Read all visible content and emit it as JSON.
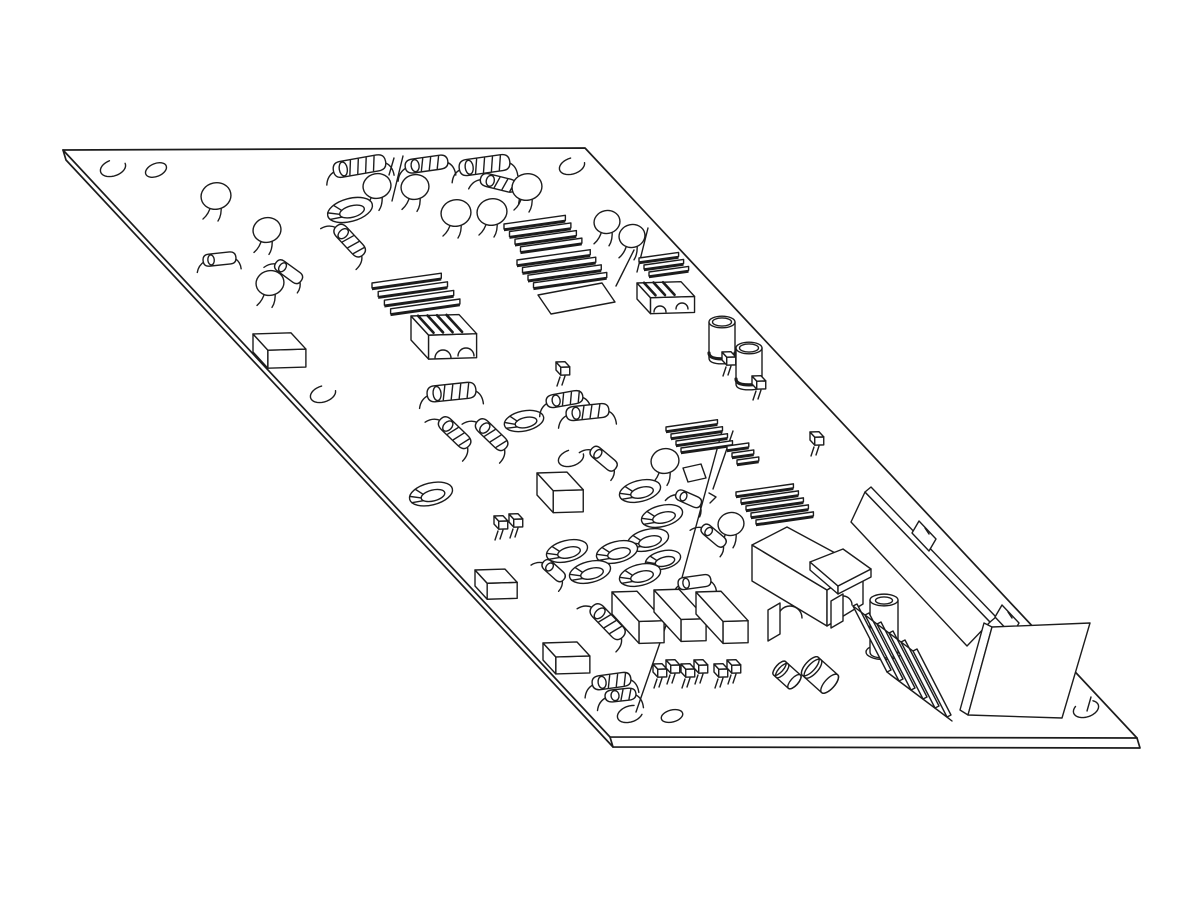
{
  "meta": {
    "title": "isometric-pcb-line-drawing",
    "background_color": "#ffffff",
    "line_color": "#1c1c1c",
    "canvas": {
      "width": 1200,
      "height": 900
    }
  },
  "board": {
    "outline": [
      [
        63,
        150
      ],
      [
        585,
        148
      ],
      [
        1137,
        738
      ],
      [
        610,
        737
      ]
    ],
    "thickness": [
      [
        63,
        150
      ],
      [
        66,
        160
      ],
      [
        613,
        747
      ],
      [
        1140,
        748
      ],
      [
        1137,
        738
      ]
    ],
    "corner_edge": [
      610,
      737,
      613,
      747
    ]
  },
  "holes": [
    {
      "k": "c",
      "x": 113,
      "y": 168,
      "g": -50
    },
    {
      "k": "e",
      "x": 156,
      "y": 170,
      "rx": 11,
      "ry": 6.5,
      "rot": -22
    },
    {
      "k": "c",
      "x": 572,
      "y": 166,
      "g": -40
    },
    {
      "k": "c",
      "x": 323,
      "y": 394,
      "g": -40
    },
    {
      "k": "c",
      "x": 571,
      "y": 458,
      "g": -45
    },
    {
      "k": "c",
      "x": 630,
      "y": 714,
      "g": -15
    },
    {
      "k": "e",
      "x": 672,
      "y": 716,
      "rx": 11,
      "ry": 6,
      "rot": -15
    },
    {
      "k": "c",
      "x": 1086,
      "y": 709,
      "g": -90
    }
  ],
  "marks": [
    {
      "l": [
        403,
        156,
        392,
        201
      ]
    },
    {
      "l": [
        394,
        158,
        389,
        175
      ]
    },
    {
      "l": [
        648,
        228,
        637,
        272
      ]
    },
    {
      "l": [
        634,
        250,
        616,
        286
      ]
    },
    {
      "pl": [
        [
          722,
          431
        ],
        [
          680,
          585
        ],
        [
          636,
          712
        ]
      ]
    },
    {
      "l": [
        733,
        431,
        713,
        489
      ]
    },
    {
      "pl": [
        [
          709,
          493
        ],
        [
          716,
          497
        ],
        [
          710,
          503
        ]
      ]
    },
    {
      "l": [
        1091,
        697,
        1087,
        711
      ]
    }
  ],
  "components": [
    {
      "t": "disc",
      "x": 216,
      "y": 196,
      "r": 15
    },
    {
      "t": "disc",
      "x": 267,
      "y": 230,
      "r": 14
    },
    {
      "t": "diode",
      "x": 220,
      "y": 259,
      "a": -6,
      "l": 28,
      "r": 6
    },
    {
      "t": "disc",
      "x": 270,
      "y": 283,
      "r": 14
    },
    {
      "t": "diode",
      "x": 289,
      "y": 272,
      "a": 36,
      "l": 26,
      "r": 6
    },
    {
      "t": "res",
      "x": 360,
      "y": 166,
      "a": -10,
      "l": 46,
      "r": 8,
      "b": 4
    },
    {
      "t": "disc",
      "x": 377,
      "y": 186,
      "r": 14
    },
    {
      "t": "disc",
      "x": 415,
      "y": 187,
      "r": 14
    },
    {
      "t": "toroid",
      "x": 350,
      "y": 210,
      "rot": -15,
      "rx": 23
    },
    {
      "t": "res",
      "x": 350,
      "y": 241,
      "a": 47,
      "l": 32,
      "r": 7,
      "b": 3
    },
    {
      "t": "res",
      "x": 427,
      "y": 164,
      "a": -8,
      "l": 36,
      "r": 7,
      "b": 3
    },
    {
      "t": "res",
      "x": 485,
      "y": 165,
      "a": -8,
      "l": 44,
      "r": 8,
      "b": 4
    },
    {
      "t": "res",
      "x": 499,
      "y": 183,
      "a": 14,
      "l": 30,
      "r": 6.5,
      "b": 3
    },
    {
      "t": "disc",
      "x": 527,
      "y": 187,
      "r": 15
    },
    {
      "t": "disc",
      "x": 456,
      "y": 213,
      "r": 15
    },
    {
      "t": "disc",
      "x": 492,
      "y": 212,
      "r": 15
    },
    {
      "t": "disc",
      "x": 607,
      "y": 222,
      "r": 13
    },
    {
      "t": "disc",
      "x": 632,
      "y": 236,
      "r": 13
    },
    {
      "t": "hs",
      "fins": [
        {
          "x": 504,
          "y": 224,
          "n": 4,
          "len": 62,
          "sx": 5.5,
          "sy": 7.6,
          "fh": 5
        },
        {
          "x": 517,
          "y": 260,
          "n": 4,
          "len": 74,
          "sx": 5.5,
          "sy": 7.6,
          "fh": 5
        }
      ],
      "plate": [
        [
          538,
          295
        ],
        [
          602,
          283
        ],
        [
          615,
          302
        ],
        [
          551,
          314
        ]
      ]
    },
    {
      "t": "hs",
      "fins": [
        {
          "x": 639,
          "y": 258,
          "n": 3,
          "len": 40,
          "sx": 5,
          "sy": 7,
          "fh": 4
        }
      ],
      "block": {
        "x": 637,
        "y": 283,
        "w": 44,
        "d": 20,
        "h": 16
      },
      "stripes": 3,
      "arches": [
        [
          660,
          312,
          6
        ],
        [
          682,
          309,
          6
        ]
      ]
    },
    {
      "t": "hs",
      "fins": [
        {
          "x": 372,
          "y": 283,
          "n": 4,
          "len": 70,
          "sx": 6.2,
          "sy": 8.6,
          "fh": 5
        }
      ],
      "block": {
        "x": 411,
        "y": 316,
        "w": 48,
        "d": 26,
        "h": 24
      },
      "stripes": 4,
      "arches": [
        [
          443,
          358,
          8
        ],
        [
          466,
          356,
          8
        ]
      ]
    },
    {
      "t": "trans",
      "x": 556,
      "y": 362
    },
    {
      "t": "ecap",
      "x": 722,
      "y": 322,
      "r": 13,
      "h": 36
    },
    {
      "t": "trans",
      "x": 722,
      "y": 352
    },
    {
      "t": "ecap",
      "x": 749,
      "y": 348,
      "r": 13,
      "h": 36
    },
    {
      "t": "trans",
      "x": 752,
      "y": 376
    },
    {
      "t": "trans",
      "x": 810,
      "y": 432
    },
    {
      "t": "box",
      "x": 253,
      "y": 334,
      "w": 38,
      "d": 22,
      "h": 18
    },
    {
      "t": "res",
      "x": 452,
      "y": 392,
      "a": -6,
      "l": 42,
      "r": 8,
      "b": 4
    },
    {
      "t": "toroid",
      "x": 524,
      "y": 421,
      "rot": -12,
      "rx": 20
    },
    {
      "t": "res",
      "x": 455,
      "y": 433,
      "a": 44,
      "l": 32,
      "r": 7,
      "b": 3
    },
    {
      "t": "res",
      "x": 492,
      "y": 435,
      "a": 44,
      "l": 32,
      "r": 7,
      "b": 3
    },
    {
      "t": "toroid",
      "x": 431,
      "y": 494,
      "rot": -14,
      "rx": 22
    },
    {
      "t": "res",
      "x": 565,
      "y": 399,
      "a": -10,
      "l": 30,
      "r": 6.5,
      "b": 3
    },
    {
      "t": "res",
      "x": 588,
      "y": 412,
      "a": -6,
      "l": 36,
      "r": 7,
      "b": 3
    },
    {
      "t": "box",
      "x": 537,
      "y": 473,
      "w": 30,
      "d": 24,
      "h": 22
    },
    {
      "t": "diode",
      "x": 604,
      "y": 459,
      "a": 40,
      "l": 26,
      "r": 6
    },
    {
      "t": "hs",
      "fins": [
        {
          "x": 666,
          "y": 427,
          "n": 4,
          "len": 52,
          "sx": 5,
          "sy": 7,
          "fh": 4
        },
        {
          "x": 727,
          "y": 446,
          "n": 3,
          "len": 22,
          "sx": 5,
          "sy": 7,
          "fh": 4
        }
      ],
      "tab": [
        [
          683,
          468
        ],
        [
          701,
          464
        ],
        [
          706,
          478
        ],
        [
          688,
          482
        ]
      ]
    },
    {
      "t": "disc",
      "x": 665,
      "y": 461,
      "r": 14
    },
    {
      "t": "diode",
      "x": 689,
      "y": 499,
      "a": 24,
      "l": 22,
      "r": 5.5
    },
    {
      "t": "disc",
      "x": 731,
      "y": 524,
      "r": 13
    },
    {
      "t": "diode",
      "x": 714,
      "y": 536,
      "a": 40,
      "l": 24,
      "r": 5.5
    },
    {
      "t": "trans",
      "x": 494,
      "y": 516
    },
    {
      "t": "trans",
      "x": 509,
      "y": 514
    },
    {
      "t": "toroid",
      "x": 640,
      "y": 491,
      "rot": -14,
      "rx": 21
    },
    {
      "t": "toroid",
      "x": 662,
      "y": 516,
      "rot": -14,
      "rx": 21
    },
    {
      "t": "toroid",
      "x": 648,
      "y": 540,
      "rot": -14,
      "rx": 21
    },
    {
      "t": "toroid",
      "x": 617,
      "y": 552,
      "rot": -14,
      "rx": 21
    },
    {
      "t": "toroid",
      "x": 567,
      "y": 551,
      "rot": -14,
      "rx": 21
    },
    {
      "t": "toroid",
      "x": 663,
      "y": 560,
      "rot": -14,
      "rx": 18
    },
    {
      "t": "diode",
      "x": 554,
      "y": 571,
      "a": 42,
      "l": 22,
      "r": 5.5
    },
    {
      "t": "toroid",
      "x": 590,
      "y": 572,
      "rot": -14,
      "rx": 21
    },
    {
      "t": "toroid",
      "x": 640,
      "y": 575,
      "rot": -14,
      "rx": 21
    },
    {
      "t": "hs",
      "fins": [
        {
          "x": 736,
          "y": 492,
          "n": 5,
          "len": 58,
          "sx": 5,
          "sy": 7,
          "fh": 4
        }
      ]
    },
    {
      "t": "fig",
      "name": "transformer",
      "prims": [
        {
          "p": [
            [
              752,
              545
            ],
            [
              827,
              590
            ],
            [
              827,
              626
            ],
            [
              752,
              581
            ]
          ],
          "f": 1
        },
        {
          "p": [
            [
              827,
              590
            ],
            [
              863,
              568
            ],
            [
              863,
              604
            ],
            [
              827,
              626
            ]
          ],
          "f": 1
        },
        {
          "p": [
            [
              752,
              545
            ],
            [
              787,
              527
            ],
            [
              863,
              568
            ],
            [
              827,
              590
            ]
          ],
          "f": 1
        },
        {
          "a": [
            790,
            618,
            12
          ]
        },
        {
          "a": [
            843,
            605,
            9
          ]
        },
        {
          "p": [
            [
              768,
              610
            ],
            [
              780,
              603
            ],
            [
              780,
              634
            ],
            [
              768,
              641
            ]
          ],
          "f": 1
        },
        {
          "p": [
            [
              831,
              601
            ],
            [
              843,
              594
            ],
            [
              843,
              621
            ],
            [
              831,
              628
            ]
          ],
          "f": 1
        },
        {
          "p": [
            [
              810,
              562
            ],
            [
              838,
              586
            ],
            [
              838,
              594
            ],
            [
              810,
              570
            ]
          ],
          "f": 1
        },
        {
          "p": [
            [
              838,
              586
            ],
            [
              871,
              569
            ],
            [
              871,
              577
            ],
            [
              838,
              594
            ]
          ],
          "f": 1
        },
        {
          "p": [
            [
              810,
              562
            ],
            [
              843,
              549
            ],
            [
              871,
              569
            ],
            [
              838,
              586
            ]
          ],
          "f": 1
        }
      ]
    },
    {
      "t": "fig",
      "name": "output-connector",
      "prims": [
        {
          "p": [
            [
              865,
              492
            ],
            [
              990,
              622
            ],
            [
              967,
              646
            ],
            [
              851,
              522
            ]
          ],
          "f": 1
        },
        {
          "p": [
            [
              865,
              492
            ],
            [
              871,
              487
            ],
            [
              996,
              617
            ],
            [
              990,
              622
            ]
          ],
          "f": 1
        },
        {
          "p": [
            [
              912,
              533
            ],
            [
              919,
              521
            ],
            [
              936,
              539
            ],
            [
              929,
              551
            ]
          ],
          "f": 1
        },
        {
          "l": [
            925,
            528,
            929,
            534
          ]
        },
        {
          "p": [
            [
              995,
              617
            ],
            [
              1002,
              605
            ],
            [
              1019,
              623
            ],
            [
              1012,
              635
            ]
          ],
          "f": 1
        },
        {
          "l": [
            1008,
            612,
            1012,
            618
          ]
        },
        {
          "p": [
            [
              984,
              623
            ],
            [
              992,
              627
            ],
            [
              968,
              715
            ],
            [
              960,
              710
            ]
          ],
          "f": 1
        },
        {
          "p": [
            [
              992,
              627
            ],
            [
              1090,
              623
            ],
            [
              1062,
              718
            ],
            [
              968,
              715
            ]
          ],
          "f": 1
        }
      ]
    },
    {
      "t": "standoff",
      "x": 884,
      "y": 600,
      "r": 14,
      "h": 52
    },
    {
      "t": "diode",
      "x": 695,
      "y": 582,
      "a": -8,
      "l": 28,
      "r": 6
    },
    {
      "t": "box",
      "x": 475,
      "y": 570,
      "w": 30,
      "d": 18,
      "h": 16
    },
    {
      "t": "box",
      "x": 543,
      "y": 643,
      "w": 34,
      "d": 19,
      "h": 17
    },
    {
      "t": "box",
      "x": 612,
      "y": 592,
      "w": 25,
      "d": 40,
      "h": 22
    },
    {
      "t": "box",
      "x": 654,
      "y": 590,
      "w": 25,
      "d": 40,
      "h": 22
    },
    {
      "t": "box",
      "x": 696,
      "y": 592,
      "w": 25,
      "d": 40,
      "h": 22
    },
    {
      "t": "res",
      "x": 608,
      "y": 622,
      "a": 46,
      "l": 36,
      "r": 7.5,
      "b": 3
    },
    {
      "t": "trans",
      "x": 653,
      "y": 664
    },
    {
      "t": "trans",
      "x": 666,
      "y": 660
    },
    {
      "t": "trans",
      "x": 681,
      "y": 664
    },
    {
      "t": "trans",
      "x": 694,
      "y": 660
    },
    {
      "t": "trans",
      "x": 714,
      "y": 664
    },
    {
      "t": "trans",
      "x": 727,
      "y": 660
    },
    {
      "t": "res",
      "x": 612,
      "y": 681,
      "a": -8,
      "l": 32,
      "r": 7,
      "b": 3
    },
    {
      "t": "res",
      "x": 621,
      "y": 695,
      "a": -6,
      "l": 24,
      "r": 6,
      "b": 2
    },
    {
      "t": "scyl",
      "x": 787,
      "y": 675,
      "a": 42,
      "l": 20,
      "r": 9
    },
    {
      "t": "scyl",
      "x": 820,
      "y": 675,
      "a": 42,
      "l": 26,
      "r": 12
    },
    {
      "t": "hs6",
      "x": 853,
      "y": 606,
      "n": 6,
      "sx": 12,
      "sy": 9,
      "vx": 34,
      "vy": 66
    }
  ]
}
